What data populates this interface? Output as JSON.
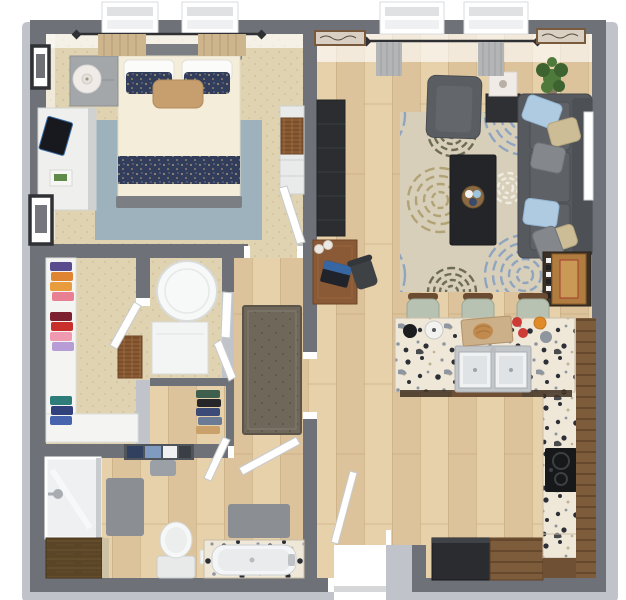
{
  "meta": {
    "title": "3D rendered one-bedroom apartment floor plan, top-down view",
    "view": "top-down 3d floor plan",
    "canvas": {
      "width": 626,
      "height": 600
    }
  },
  "palette": {
    "wall": "#6e7177",
    "wallBevel": "#c0c4ca",
    "white": "#ffffff",
    "carpet": "#e0d3b2",
    "carpetDot": "#d2c19c",
    "wood": "#dcc39b",
    "woodLight": "#e6d1ab",
    "woodSeam": "#c2a478",
    "graniteBase": "#efe8d9",
    "graniteDark": "#2c2f35",
    "graniteGray": "#8f96a0",
    "graniteTan": "#bfb196",
    "rugBase": "#d7cfba",
    "rugBlue": "#8fa5bf",
    "rugTan": "#b2a376",
    "rugOlive": "#6f6c56",
    "rugCream": "#efece0",
    "bedroomRug": "#9db2bd",
    "navy": "#323d5b",
    "navyDot": "#c3ad7e",
    "duvet": "#f3edda",
    "pillowWhite": "#fbfbf9",
    "pillowTan": "#c79e6e",
    "bedFrame": "#7b7f84",
    "nightstand": "#a3a7a9",
    "dresserWhite": "#eff0ee",
    "sofa": "#56595e",
    "sofaCushion": "#5e6267",
    "sofaBack": "#4d5055",
    "pillowBlue": "#aecbe2",
    "pillowFloral": "#cdbd96",
    "pillowGray": "#84888d",
    "armchair": "#5a5d62",
    "armchairCushion": "#63676c",
    "coffeeTable": "#232528",
    "trayWood": "#8a6a43",
    "mediaUnit": "#2b2d30",
    "deskWood": "#8a5a36",
    "chairDark": "#3f4245",
    "endTable": "#2e3033",
    "lampShade": "#f1ebe7",
    "plantGreen": "#4e7a3c",
    "plantDark": "#3c6330",
    "potBrown": "#8a7a64",
    "curtainTan": "#cdb58e",
    "curtainGray": "#b3b5b7",
    "rod": "#2e3033",
    "frameDark": "#2f3134",
    "artWood": "#7a5a3c",
    "artPaper": "#d9d0c3",
    "cabinetWood": "#7d5c3c",
    "cabinetLine": "#5e4128",
    "counterBase": "#6f5034",
    "fridge": "#2a2c2f",
    "cooktop": "#17181a",
    "stoolSeat": "#b7c2b2",
    "stoolEdge": "#99a795",
    "stoolBack": "#6b4c33",
    "sinkRim": "#c3c7ca",
    "sinkBasin": "#eff1f2",
    "runnerRug": "#6e675a",
    "runnerEdge": "#5b5448",
    "bathMat": "#8b8e92",
    "towelNavy": "#31405e",
    "towelBlue": "#7f9bc0",
    "vanityWood": "#5a4527",
    "vanityLine": "#6e5634",
    "vanityEdge": "#cfc2a4",
    "shelfDark": "#50555b",
    "tubWhite": "#f4f5f6",
    "glass": "#eef0f2",
    "hamper": "#8a5a33",
    "gameBox": "#b07c3f",
    "gameRed": "#a53b2e",
    "laptopBlue": "#3a6fb0",
    "clothesPurple": "#5a4a8e",
    "clothesOrange": "#df8430",
    "clothesAmber": "#e89c3e",
    "clothesPink": "#e87f92",
    "clothesMaroon": "#7c2030",
    "clothesRed": "#c9302c",
    "clothesRose": "#ef9ab0",
    "clothesLavender": "#b79cd6",
    "clothesTeal": "#2f7d7a",
    "clothesNavy": "#30417c",
    "clothesBlue": "#4763ae",
    "linenGreen": "#3e5e4e",
    "linenBlack": "#26262a",
    "linenNavy": "#3b4a77",
    "linenSlate": "#6c7b95",
    "linenTan": "#caa06b",
    "appleRed": "#cc3b35",
    "ojOrange": "#e08b2a",
    "board": "#cbb089",
    "bread": "#c08a4f",
    "potBlack": "#1b1d1f",
    "potWhite": "#f2f2f0",
    "jarGray": "#8d959e"
  },
  "scene": {
    "rooms": [
      {
        "name": "bedroom",
        "flooring": "carpet",
        "furniture": [
          "bed",
          "area-rug",
          "nightstand",
          "table-lamp",
          "dresser",
          "tablet",
          "wall-art",
          "side-dresser",
          "woven-basket",
          "curtained-windows"
        ]
      },
      {
        "name": "living-room",
        "flooring": "hardwood",
        "furniture": [
          "sofa",
          "throw-pillows",
          "armchair",
          "end-table-lamp",
          "coffee-table",
          "decor-tray",
          "floral-rug",
          "media-console",
          "desk",
          "laptop",
          "desk-chair",
          "game-side-table",
          "potted-plant",
          "wall-art",
          "curtained-windows"
        ]
      },
      {
        "name": "kitchen",
        "flooring": "hardwood",
        "furniture": [
          "island-counter",
          "double-sink",
          "bar-stools",
          "cooktop",
          "refrigerator",
          "base-cabinet",
          "wall-cabinets",
          "cutting-board",
          "tomatoes",
          "juice-glass"
        ]
      },
      {
        "name": "walk-in-closet",
        "flooring": "carpet",
        "furniture": [
          "closet-system",
          "hanging-clothes",
          "hamper"
        ]
      },
      {
        "name": "laundry-closet",
        "flooring": "carpet",
        "furniture": [
          "stacked-washer-dryer",
          "bifold-doors"
        ]
      },
      {
        "name": "linen-closet",
        "flooring": "hardwood",
        "furniture": [
          "hanging-clothes"
        ]
      },
      {
        "name": "hallway",
        "flooring": "hardwood",
        "furniture": [
          "runner-rug"
        ]
      },
      {
        "name": "bathroom",
        "flooring": "hardwood",
        "furniture": [
          "shower",
          "vanity-cabinet",
          "toilet",
          "bathtub",
          "bath-mats",
          "towel-shelf"
        ]
      },
      {
        "name": "entry",
        "flooring": "hardwood",
        "furniture": [
          "front-door"
        ]
      }
    ],
    "windows": {
      "count": 4,
      "locations": [
        "bedroom-top-left",
        "bedroom-top-right",
        "living-top-left",
        "living-top-right"
      ]
    },
    "doors": [
      "bedroom-door",
      "closet-door",
      "bathroom-door",
      "front-door",
      "laundry-bifold-doors",
      "linen-closet-door"
    ],
    "stool_count": 3
  }
}
